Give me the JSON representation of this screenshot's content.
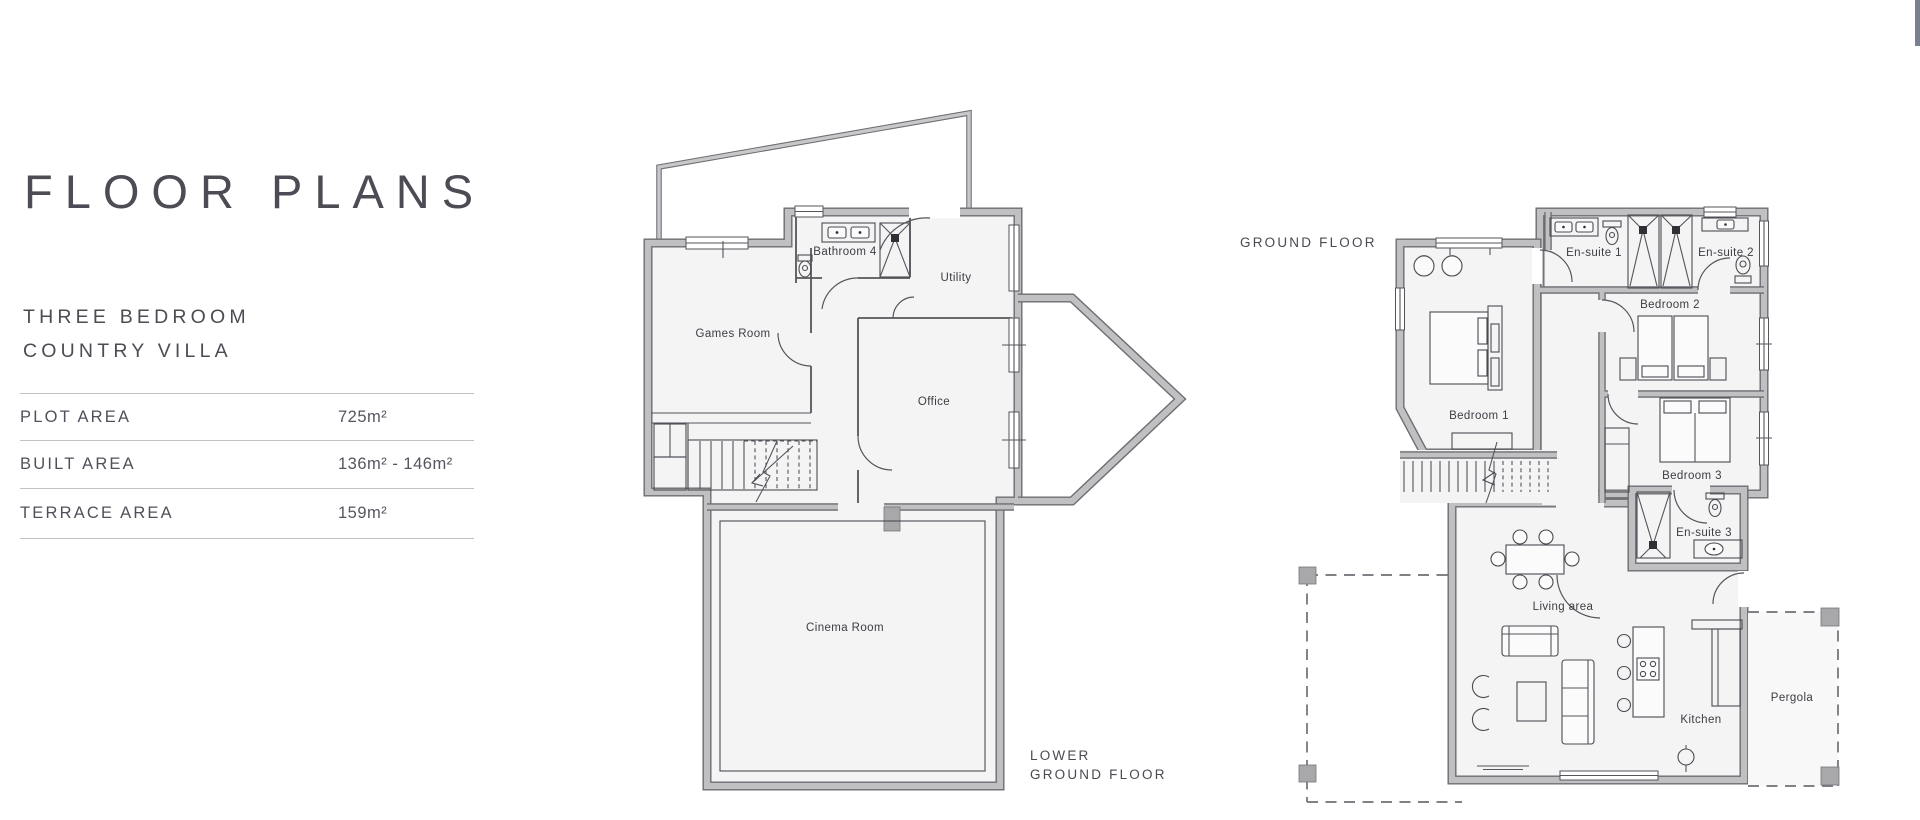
{
  "page": {
    "background": "#ffffff"
  },
  "info_panel": {
    "title": "FLOOR PLANS",
    "subtitle_line1": "THREE BEDROOM",
    "subtitle_line2": "COUNTRY VILLA",
    "specs": [
      {
        "label": "PLOT AREA",
        "value": "725m²"
      },
      {
        "label": "BUILT AREA",
        "value": "136m² - 146m²"
      },
      {
        "label": "TERRACE AREA",
        "value": "159m²"
      }
    ]
  },
  "lower_ground_floor": {
    "caption_line1": "LOWER",
    "caption_line2": "GROUND FLOOR",
    "rooms": {
      "games_room": "Games Room",
      "bathroom_4": "Bathroom 4",
      "utility": "Utility",
      "office": "Office",
      "cinema_room": "Cinema Room"
    }
  },
  "ground_floor": {
    "caption": "GROUND FLOOR",
    "rooms": {
      "bedroom_1": "Bedroom 1",
      "bedroom_2": "Bedroom 2",
      "bedroom_3": "Bedroom 3",
      "en_suite_1": "En-suite 1",
      "en_suite_2": "En-suite 2",
      "en_suite_3": "En-suite 3",
      "living_area": "Living area",
      "kitchen": "Kitchen",
      "pergola": "Pergola"
    }
  },
  "colors": {
    "wall_fill": "#c0c0c3",
    "wall_edge": "#6d6d72",
    "floor_fill": "#f4f4f5",
    "line": "#55555b",
    "text": "#3c3c43",
    "heading_text": "#4c4c54",
    "divider": "#c0c3c6",
    "corner_accent": "#78808f"
  }
}
